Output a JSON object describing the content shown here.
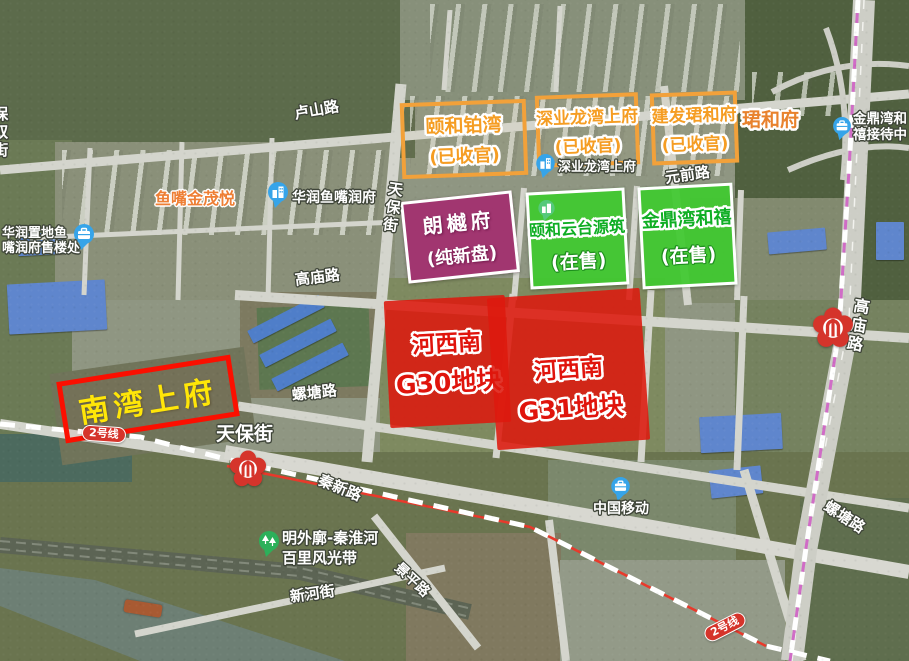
{
  "plots": {
    "sold_out": [
      {
        "name": "颐和铂湾",
        "status": "(已收官)"
      },
      {
        "name": "深业龙湾上府",
        "status": "(已收官)"
      },
      {
        "name": "建发珺和府",
        "status": "(已收官)"
      }
    ],
    "new_plot": {
      "name": "朗樾府",
      "status": "(纯新盘)"
    },
    "on_sale": [
      {
        "name": "颐和云台源筑",
        "status": "(在售)"
      },
      {
        "name": "金鼎湾和禧",
        "status": "(在售)"
      }
    ],
    "land": [
      {
        "area": "河西南",
        "parcel": "G30地块"
      },
      {
        "area": "河西南",
        "parcel": "G31地块"
      }
    ],
    "highlight": {
      "name": "南湾上府"
    }
  },
  "roads": {
    "lushanlu": "卢山路",
    "tianbaojie_v": "天保街",
    "yuanqianlu": "元前路",
    "gaomiaolu": "高庙路",
    "luotanglu": "螺塘路",
    "gaomiaolu_east": "高庙路",
    "luotanglu_east": "螺塘路",
    "qinxinlu": "秦新路",
    "xinhejie": "新河街",
    "jingpinglu": "景平路",
    "baoshuangjie": "保双街",
    "tianbaojie_station": "天保街"
  },
  "metro": {
    "line2_badge": "2号线"
  },
  "pois": {
    "yuzuijinmaoyue": {
      "name": "鱼嘴金茂悦"
    },
    "huarun_runfu": {
      "name": "华润鱼嘴润府"
    },
    "shoulouchu": {
      "line1": "华润置地鱼",
      "line2": "嘴润府售楼处"
    },
    "shenye_base": {
      "name": "深业龙湾上府"
    },
    "jiedai_center": {
      "line1": "金鼎湾和",
      "line2": "禧接待中"
    },
    "zhongguo_yidong": {
      "name": "中国移动"
    },
    "mingwaiguo": {
      "line1": "明外廓-秦淮河",
      "line2": "百里风光带"
    },
    "junhefu_base": {
      "name": "珺和府"
    }
  },
  "colors": {
    "sold_out_orange": "#f2a13a",
    "new_purple": "#a2306f",
    "on_sale_green": "#3fc92f",
    "land_red": "#dd190e",
    "highlight_border_red": "#fb0f00",
    "highlight_text_yellow": "#ffe608",
    "metro_badge_red": "#d5342b",
    "metro_line_magenta": "#d06cc6",
    "metro_line_red": "#e8392b"
  }
}
